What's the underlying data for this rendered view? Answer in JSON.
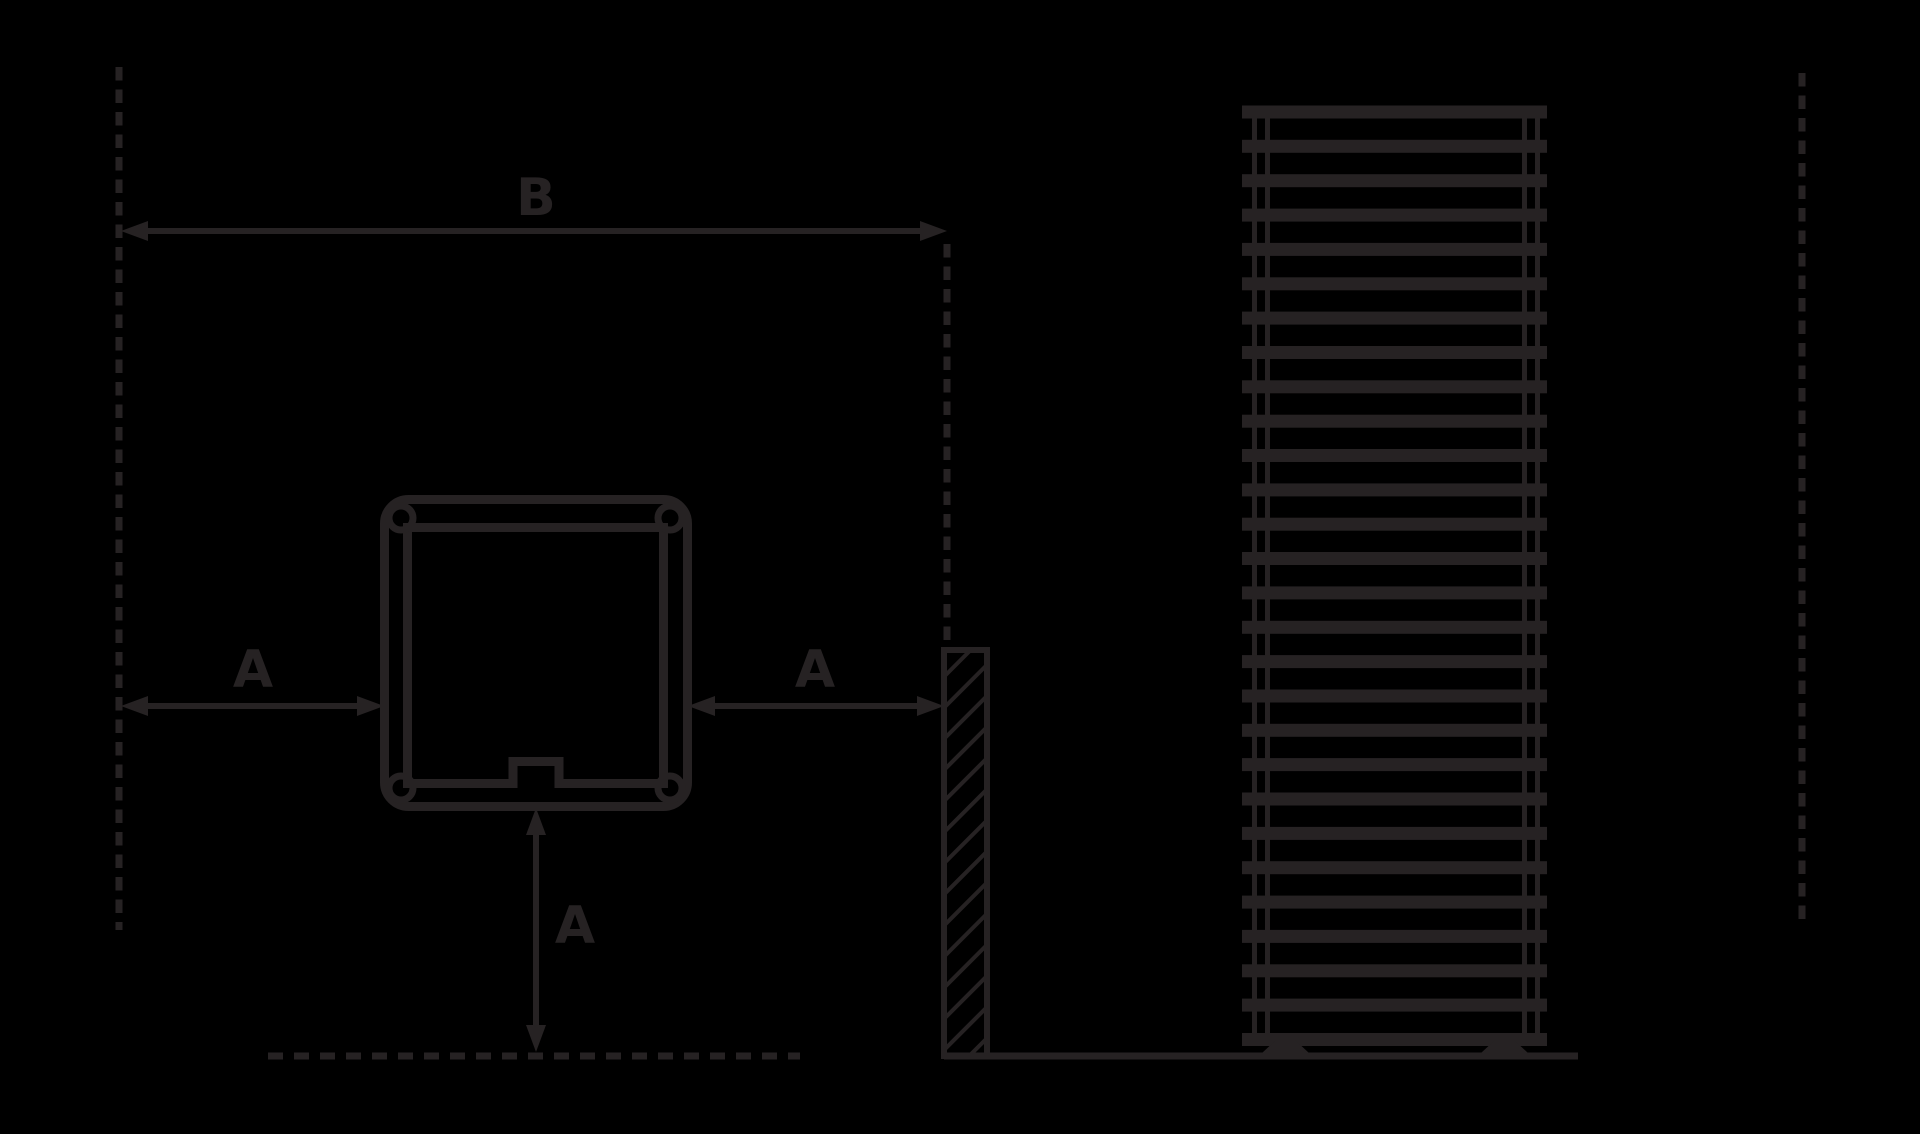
{
  "diagram": {
    "dimension_labels": {
      "b": "B",
      "a_left": "A",
      "a_right": "A",
      "a_bottom": "A"
    }
  },
  "radiator": {
    "bar_count": 28
  },
  "colors": {
    "background": "#000000",
    "line": "#262223"
  }
}
